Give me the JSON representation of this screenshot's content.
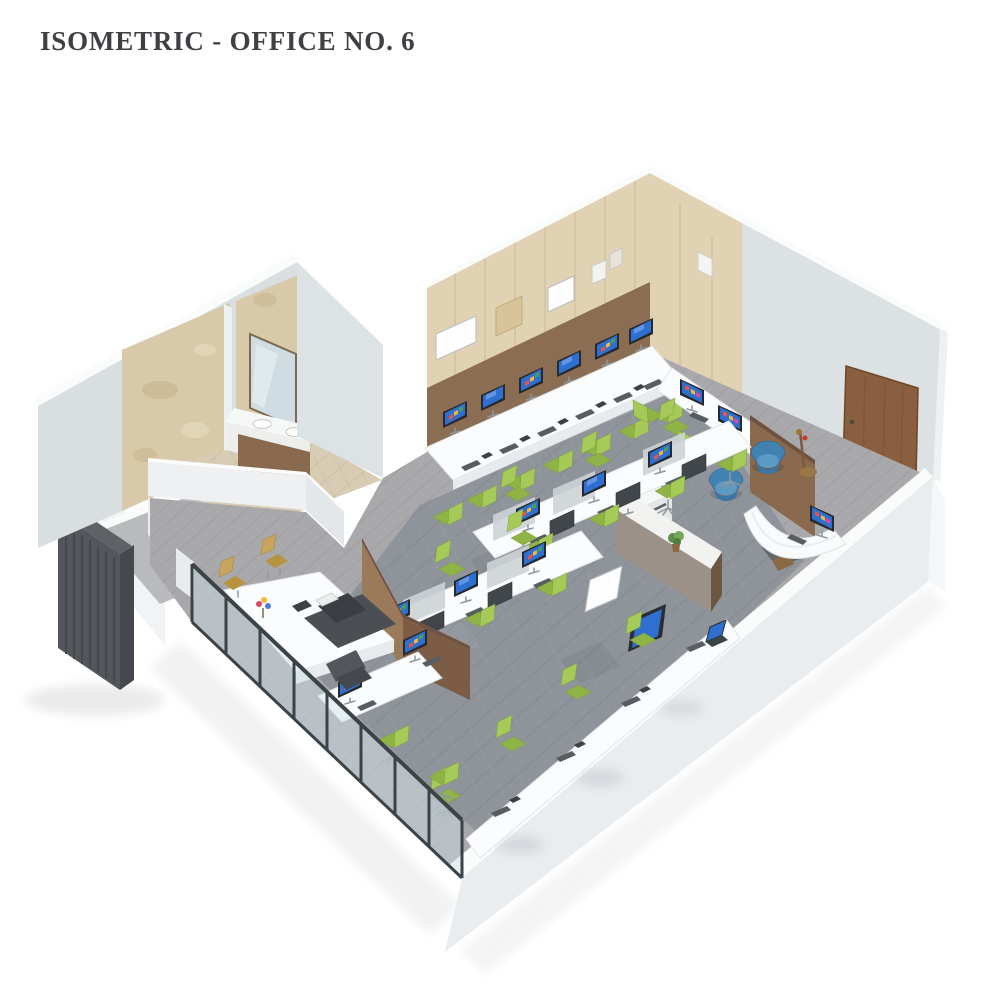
{
  "page": {
    "title": "ISOMETRIC - OFFICE NO. 6"
  },
  "palette": {
    "paper": "#ffffff",
    "ink": "#3e4044",
    "wall_white": "#f1f3f4",
    "wall_gray": "#dce2e4",
    "panel_beige": "#e2d2b4",
    "band_brown": "#8a6d52",
    "marble": "#d8caa8",
    "door_wood": "#8a5f3f",
    "floor_wood": "#a9a8ab",
    "floor_carpet": "#8f939a",
    "floor_bath": "#d8cdb4",
    "desk_white": "#fbfcfd",
    "chair_green": "#a6ca58",
    "chair_green_dark": "#8fb445",
    "chair_blue": "#4182b0",
    "chair_tan": "#c9a45d",
    "partition_brown": "#8a6a4e",
    "glass": "#cde1e6",
    "mullion": "#3c4347",
    "core_dark": "#53575b",
    "screen_blue": "#2f6fd0"
  }
}
